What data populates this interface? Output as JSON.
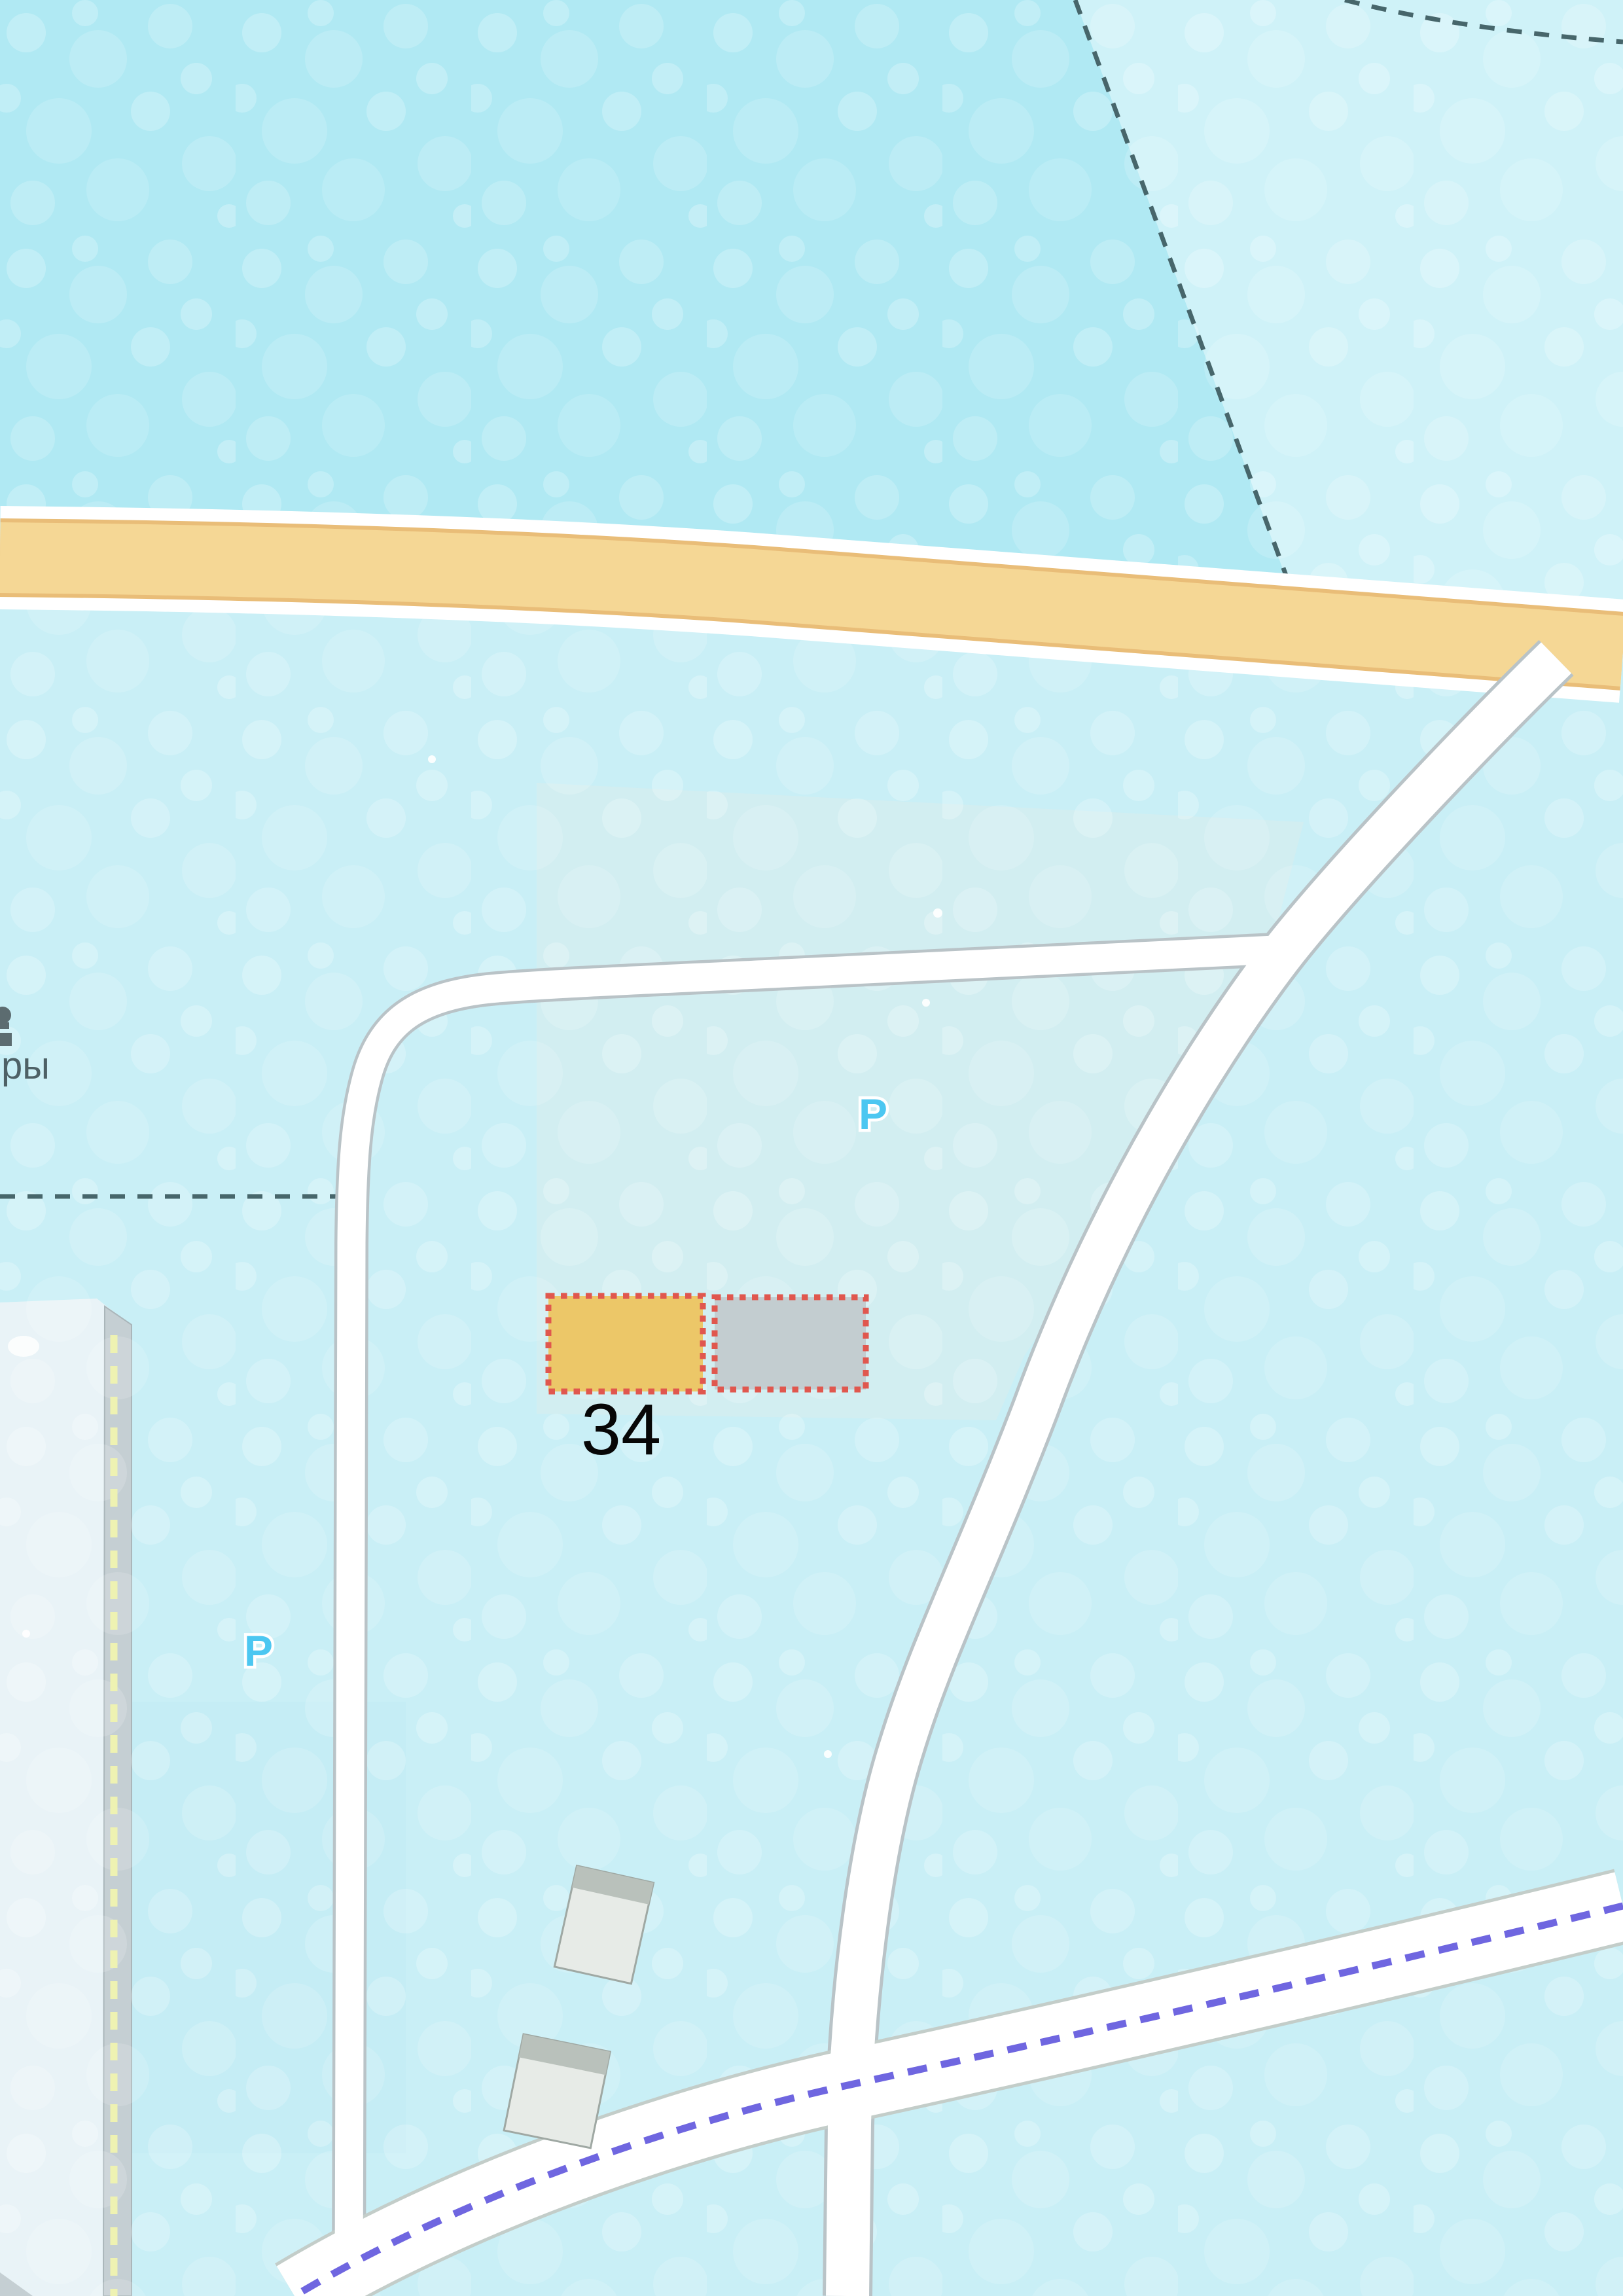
{
  "map": {
    "parcel_label": "34",
    "cutoff_street_label": "ры",
    "parking_label": "P",
    "parcels": [
      {
        "name": "highlighted-parcel-yellow",
        "label": "34",
        "fill": "#ecc768",
        "border": "#e0574e"
      },
      {
        "name": "highlighted-parcel-gray",
        "fill": "#c3cdd0",
        "border": "#e0574e"
      }
    ],
    "palette": {
      "forest_dense": "#b0e9f3",
      "forest_light": "#c9eff6",
      "forest_far": "#cff2f8",
      "clearing": "#d4edf0",
      "major_road_fill": "#f5d795",
      "major_road_border": "#e9bd78",
      "minor_road_fill": "#ffffff",
      "minor_road_casing": "#b9c3c7",
      "boundary_dash": "#47666b",
      "trail_dash": "#6f66e0",
      "parking_blue": "#4cc7f1",
      "building_fill": "#e7ebe7",
      "building_roof": "#b9c1bb",
      "industrial_fill": "#e9f3f7",
      "industrial_band": "#c5cfd3",
      "fence_dash_yellow": "#eef2b2",
      "parcel_label_color": "#070707"
    }
  }
}
